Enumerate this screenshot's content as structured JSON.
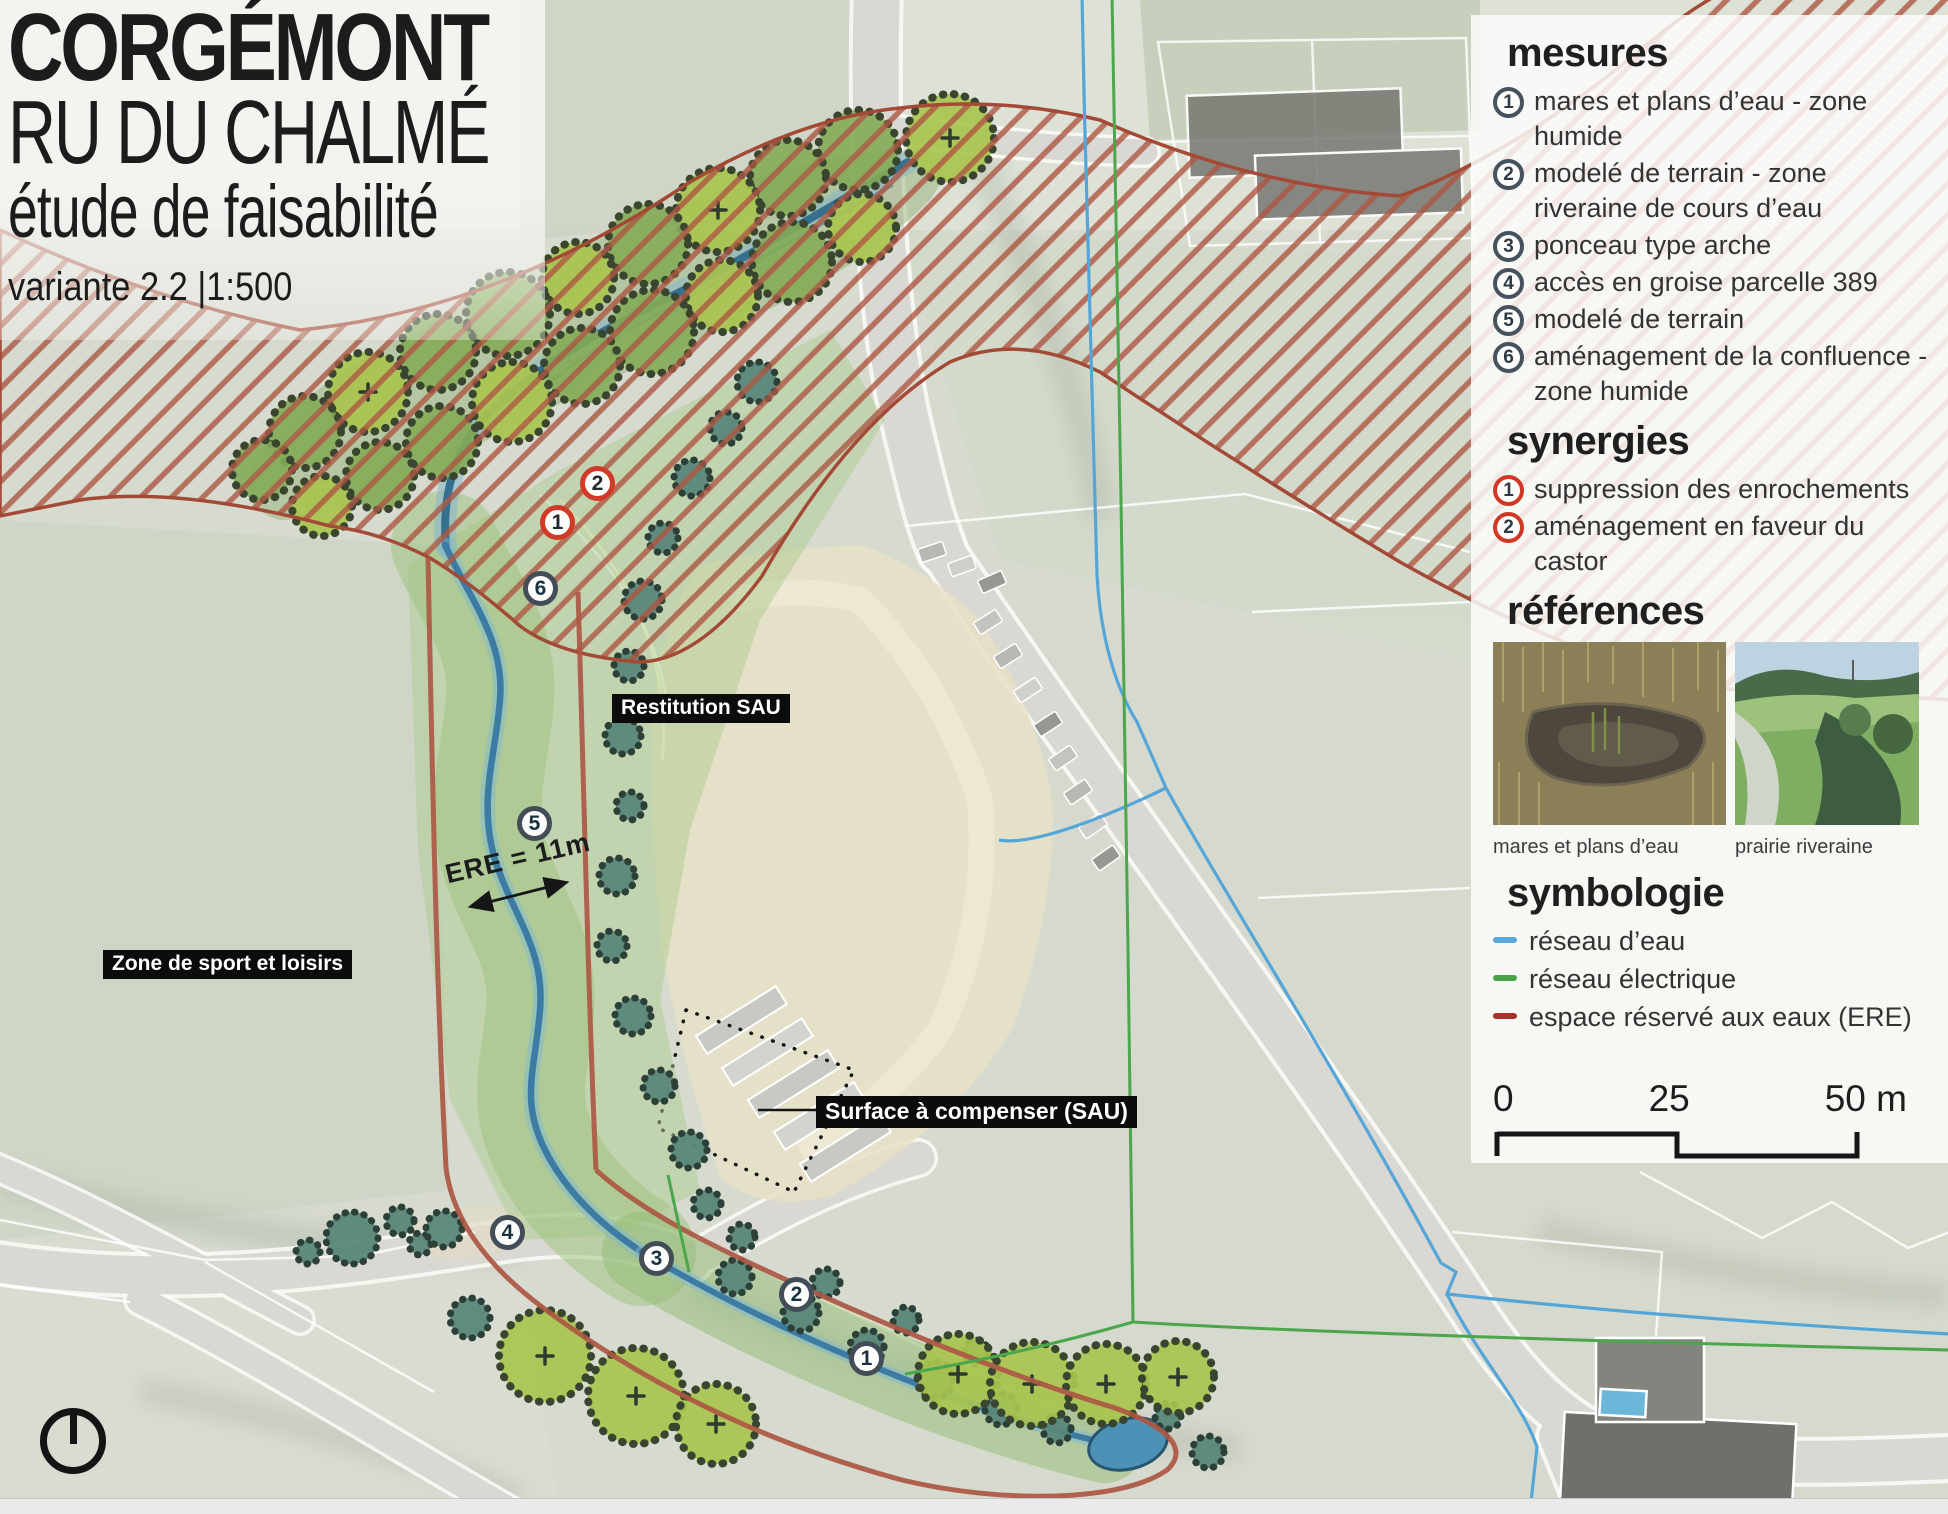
{
  "title": {
    "line1": "CORGÉMONT",
    "line2": "RU DU CHALMÉ",
    "line3": "étude de faisabilité",
    "line4": "variante 2.2 |1:500"
  },
  "panel": {
    "mesures_heading": "mesures",
    "mesures": [
      {
        "num": "1",
        "text": "mares et plans d’eau - zone humide"
      },
      {
        "num": "2",
        "text": "modelé de terrain - zone riveraine de cours d’eau"
      },
      {
        "num": "3",
        "text": "ponceau type arche"
      },
      {
        "num": "4",
        "text": "accès en groise parcelle 389"
      },
      {
        "num": "5",
        "text": "modelé de terrain"
      },
      {
        "num": "6",
        "text": "aménagement de la confluence - zone humide"
      }
    ],
    "synergies_heading": "synergies",
    "synergies": [
      {
        "num": "1",
        "text": "suppression des enrochements"
      },
      {
        "num": "2",
        "text": "aménagement en faveur du castor"
      }
    ],
    "references_heading": "références",
    "references": [
      {
        "caption": "mares et plans d’eau"
      },
      {
        "caption": "prairie riveraine"
      }
    ],
    "symbologie_heading": "symbologie",
    "symbologie": [
      {
        "label": "réseau d’eau",
        "color": "#58a8dc"
      },
      {
        "label": "réseau électrique",
        "color": "#49a449"
      },
      {
        "label": "espace réservé aux eaux (ERE)",
        "color": "#a5342a"
      }
    ],
    "scalebar": {
      "start": "0",
      "mid": "25",
      "end": "50 m"
    }
  },
  "map": {
    "labels": {
      "restitution": "Restitution SAU",
      "zone_sport": "Zone de sport et loisirs",
      "surface": "Surface à compenser (SAU)",
      "ere": "ERE = 11m"
    },
    "markers": {
      "mesures": [
        {
          "num": "1"
        },
        {
          "num": "2"
        },
        {
          "num": "3"
        },
        {
          "num": "4"
        },
        {
          "num": "5"
        },
        {
          "num": "6"
        }
      ],
      "synergies": [
        {
          "num": "1"
        },
        {
          "num": "2"
        }
      ]
    }
  },
  "colors": {
    "ere_hatch": "#ad5743",
    "measure_ring": "#46525e",
    "synergy_ring": "#d23a28",
    "water_line": "#58a8dc",
    "electric_line": "#49a449"
  }
}
